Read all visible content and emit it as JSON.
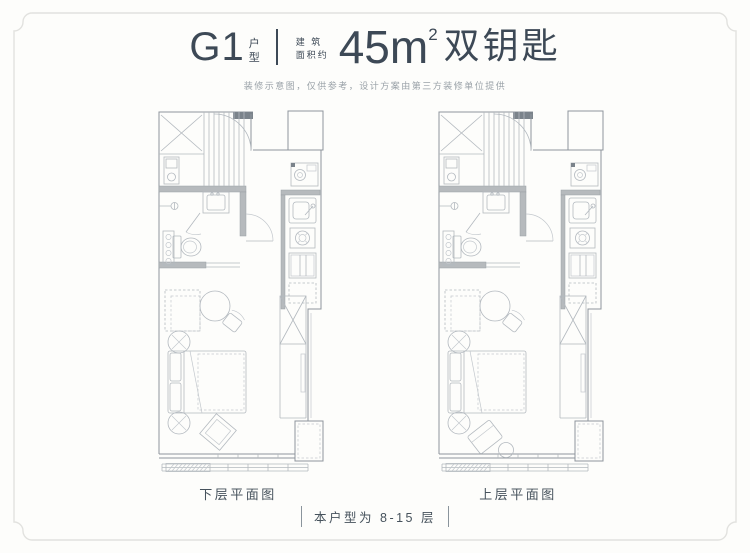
{
  "header": {
    "unit_code": "G1",
    "unit_type_top": "户",
    "unit_type_bottom": "型",
    "area_label_line1": "建 筑",
    "area_label_line2": "面积约",
    "area_value": "45m",
    "area_superscript": "2",
    "title_suffix": "双钥匙",
    "disclaimer": "装修示意图，仅供参考，设计方案由第三方装修单位提供"
  },
  "plans": [
    {
      "caption": "下层平面图"
    },
    {
      "caption": "上层平面图"
    }
  ],
  "footer": {
    "note": "本户型为 8-15 层"
  },
  "colors": {
    "accent_text": "#3d4956",
    "muted_text": "#9aa2a8",
    "caption_text": "#46525c",
    "wall_line": "#8e959c",
    "furniture_line": "#b3b9bf",
    "wall_fill": "#b6babd",
    "frame_border": "#e2e2df",
    "background": "#fdfdfb"
  }
}
